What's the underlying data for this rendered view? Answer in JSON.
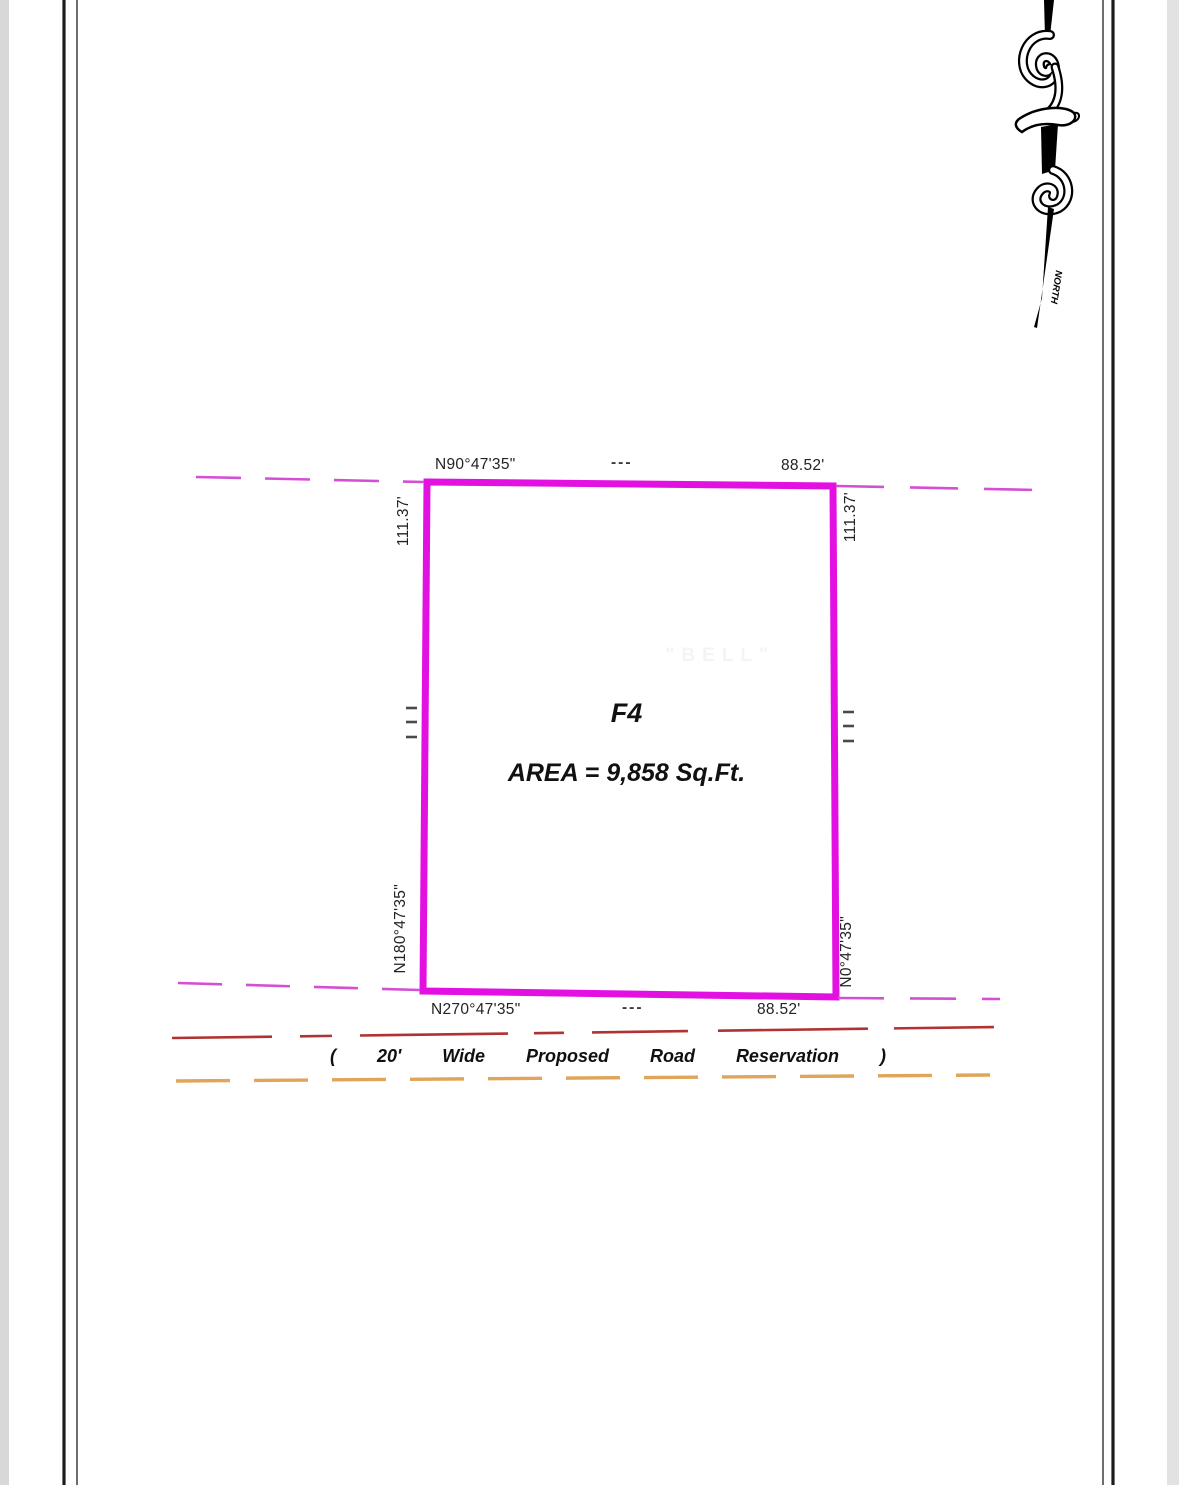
{
  "north_arrow": {
    "label": "NORTH"
  },
  "plot": {
    "name": "F4",
    "area": "AREA = 9,858 Sq.Ft.",
    "ghost_text": "\"BELL\"",
    "top_edge": {
      "bearing": "N90°47'35\"",
      "ticks": "---",
      "distance": "88.52'"
    },
    "bottom_edge": {
      "bearing": "N270°47'35\"",
      "ticks": "---",
      "distance": "88.52'"
    },
    "left_edge": {
      "distance": "111.37'",
      "bearing": "N180°47'35\""
    },
    "right_edge": {
      "distance": "111.37'",
      "bearing": "N0°47'35\""
    }
  },
  "road_reservation": {
    "open_paren": "(",
    "width": "20'",
    "word_wide": "Wide",
    "word_proposed": "Proposed",
    "word_road": "Road",
    "word_reservation": "Reservation",
    "close_paren": ")"
  },
  "colors": {
    "boundary_magenta": "#e211e2",
    "extension_magenta": "#d44fd4",
    "road_centerline_red": "#b03232",
    "road_edge_orange": "#e0a558",
    "border_black": "#1c1c1c",
    "border_gray": "#4a4a4a",
    "tick_gray": "#4a4a4a"
  }
}
